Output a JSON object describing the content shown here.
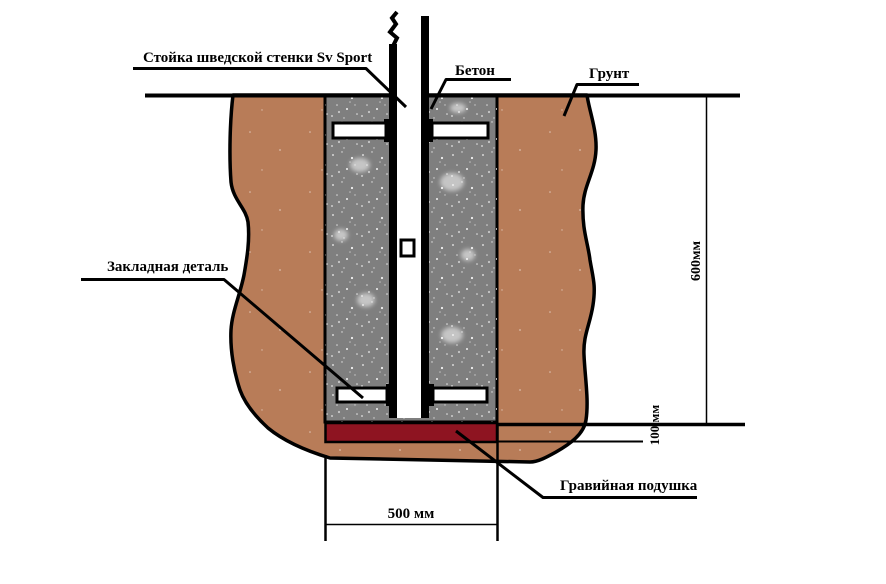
{
  "diagram": {
    "labels": {
      "post": "Стойка шведской стенки Sv Sport",
      "concrete": "Бетон",
      "soil": "Грунт",
      "embedded_part": "Закладная деталь",
      "gravel_pad": "Гравийная подушка"
    },
    "dimensions": {
      "depth": "600мм",
      "pad_thickness": "100 мм",
      "pit_width": "500 мм"
    },
    "colors": {
      "soil": "#b87c58",
      "concrete": "#7f7f7f",
      "gravel": "#8e1421",
      "line": "#000000"
    }
  }
}
